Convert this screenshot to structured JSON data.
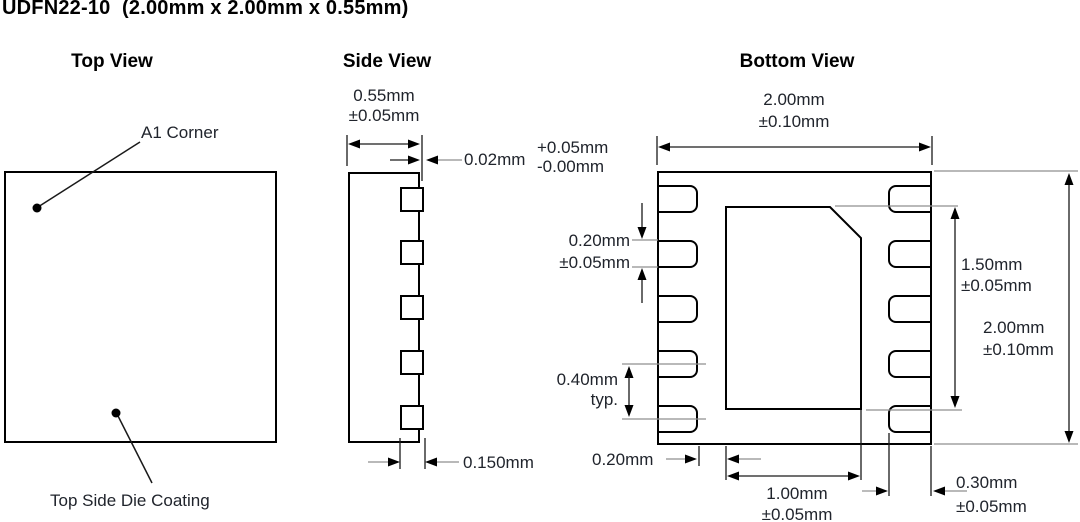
{
  "colors": {
    "outline": "#000000",
    "dimension_line": "#1a1a1a",
    "extension_gray": "#8f8f8f",
    "label_text": "#20242c",
    "background": "#ffffff"
  },
  "title": "UDFN22-10  (2.00mm x 2.00mm x 0.55mm)",
  "top_view": {
    "heading": "Top View",
    "a1_corner_label": "A1 Corner",
    "die_coating_label": "Top Side Die Coating"
  },
  "side_view": {
    "heading": "Side View",
    "package_thickness": "0.55mm",
    "package_thickness_tol": "±0.05mm",
    "terminal_protrusion": "0.02mm",
    "terminal_protrusion_tol_plus": "+0.05mm",
    "terminal_protrusion_tol_minus": "-0.00mm",
    "terminal_thickness": "0.150mm"
  },
  "bottom_view": {
    "heading": "Bottom View",
    "body_width": "2.00mm",
    "body_width_tol": "±0.10mm",
    "terminal_width": "0.20mm",
    "terminal_width_tol": "±0.05mm",
    "terminal_pitch": "0.40mm",
    "terminal_pitch_qual": "typ.",
    "terminal_to_pad_gap": "0.20mm",
    "thermal_pad_width": "1.00mm",
    "thermal_pad_width_tol": "±0.05mm",
    "thermal_pad_length": "1.50mm",
    "thermal_pad_length_tol": "±0.05mm",
    "body_length": "2.00mm",
    "body_length_tol": "±0.10mm",
    "terminal_length": "0.30mm",
    "terminal_length_tol": "±0.05mm"
  }
}
